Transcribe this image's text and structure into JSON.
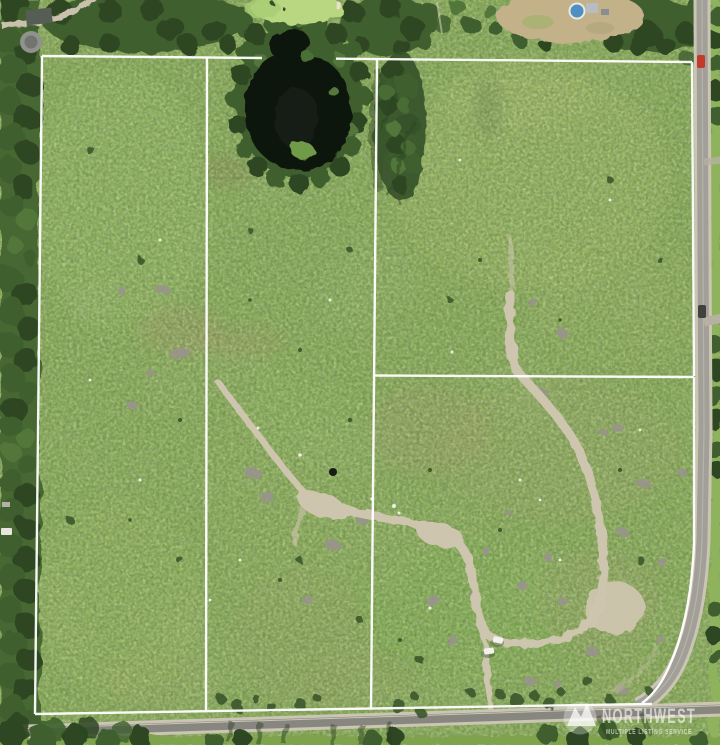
{
  "watermark": {
    "logo_icon": "mountain-peaks-logo",
    "brand_text": "NORTHWEST",
    "tagline_text": "MULTIPLE LISTING SERVICE"
  },
  "property": {
    "parcel_count": 4,
    "boundary_color": "#ffffff"
  },
  "features": [
    "property-boundary-lines",
    "pond",
    "forest-edge",
    "golf-green",
    "dry-field",
    "swimming-pool",
    "dirt-trails",
    "slash-piles",
    "paved-roads",
    "parked-cars",
    "mls-watermark"
  ],
  "colors": {
    "meadow_base": "#86ab52",
    "meadow_light": "#a2c167",
    "forest_dark": "#2d4724",
    "forest_mid": "#3f5f2e",
    "canopy_light": "#52763a",
    "pond_water": "#10150d",
    "pond_island": "#6f9b49",
    "golf_green": "#b9d780",
    "dry_field": "#c3b189",
    "pool_blue": "#4f8fc2",
    "trail_dirt": "#cec5ae",
    "slash_grey": "#9a948c",
    "road_asphalt": "#a19f97",
    "road_dark": "#87867f",
    "road_shoulder": "#cbc5b4",
    "boundary_white": "#ffffff",
    "watermark_white": "#ffffff",
    "car_red": "#c23b2a",
    "car_white": "#f2f1ea"
  }
}
